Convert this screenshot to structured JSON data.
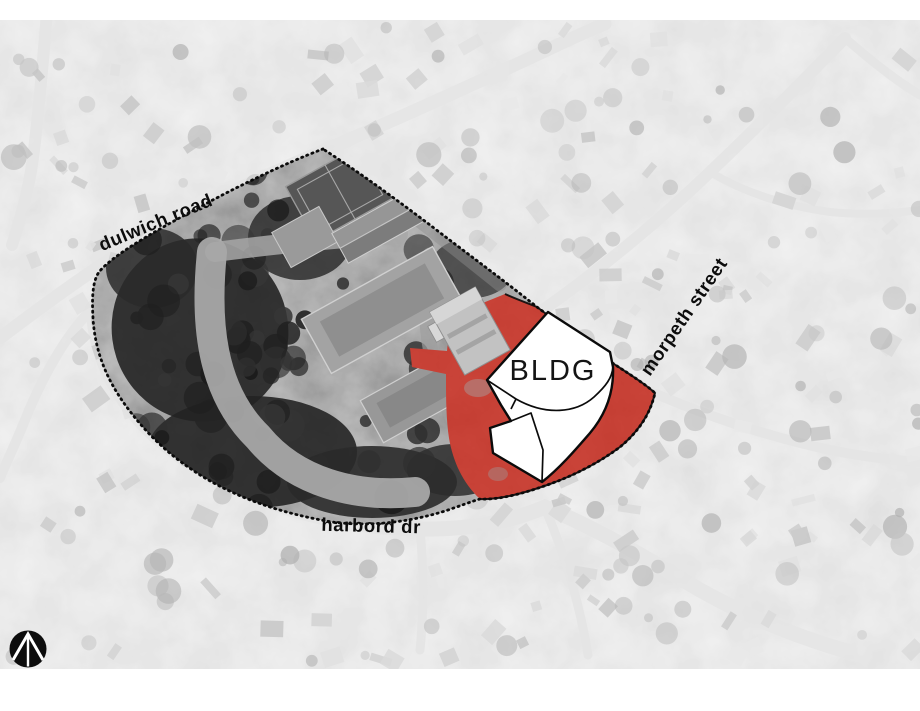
{
  "map": {
    "street_labels": [
      {
        "id": "dulwich-road",
        "text": "dulwich road"
      },
      {
        "id": "morpeth-street",
        "text": "morpeth street"
      },
      {
        "id": "harbord-dr",
        "text": "harbord dr"
      }
    ],
    "building_label": "BLDG",
    "icons": {
      "north_arrow": "north-arrow-icon"
    },
    "colors": {
      "highlight_red": "#cb2f22",
      "building_fill": "#ffffff",
      "ink": "#0b0b0b",
      "photo_base": "#c9c9c9",
      "site_shade": "#4f4f4f"
    }
  }
}
